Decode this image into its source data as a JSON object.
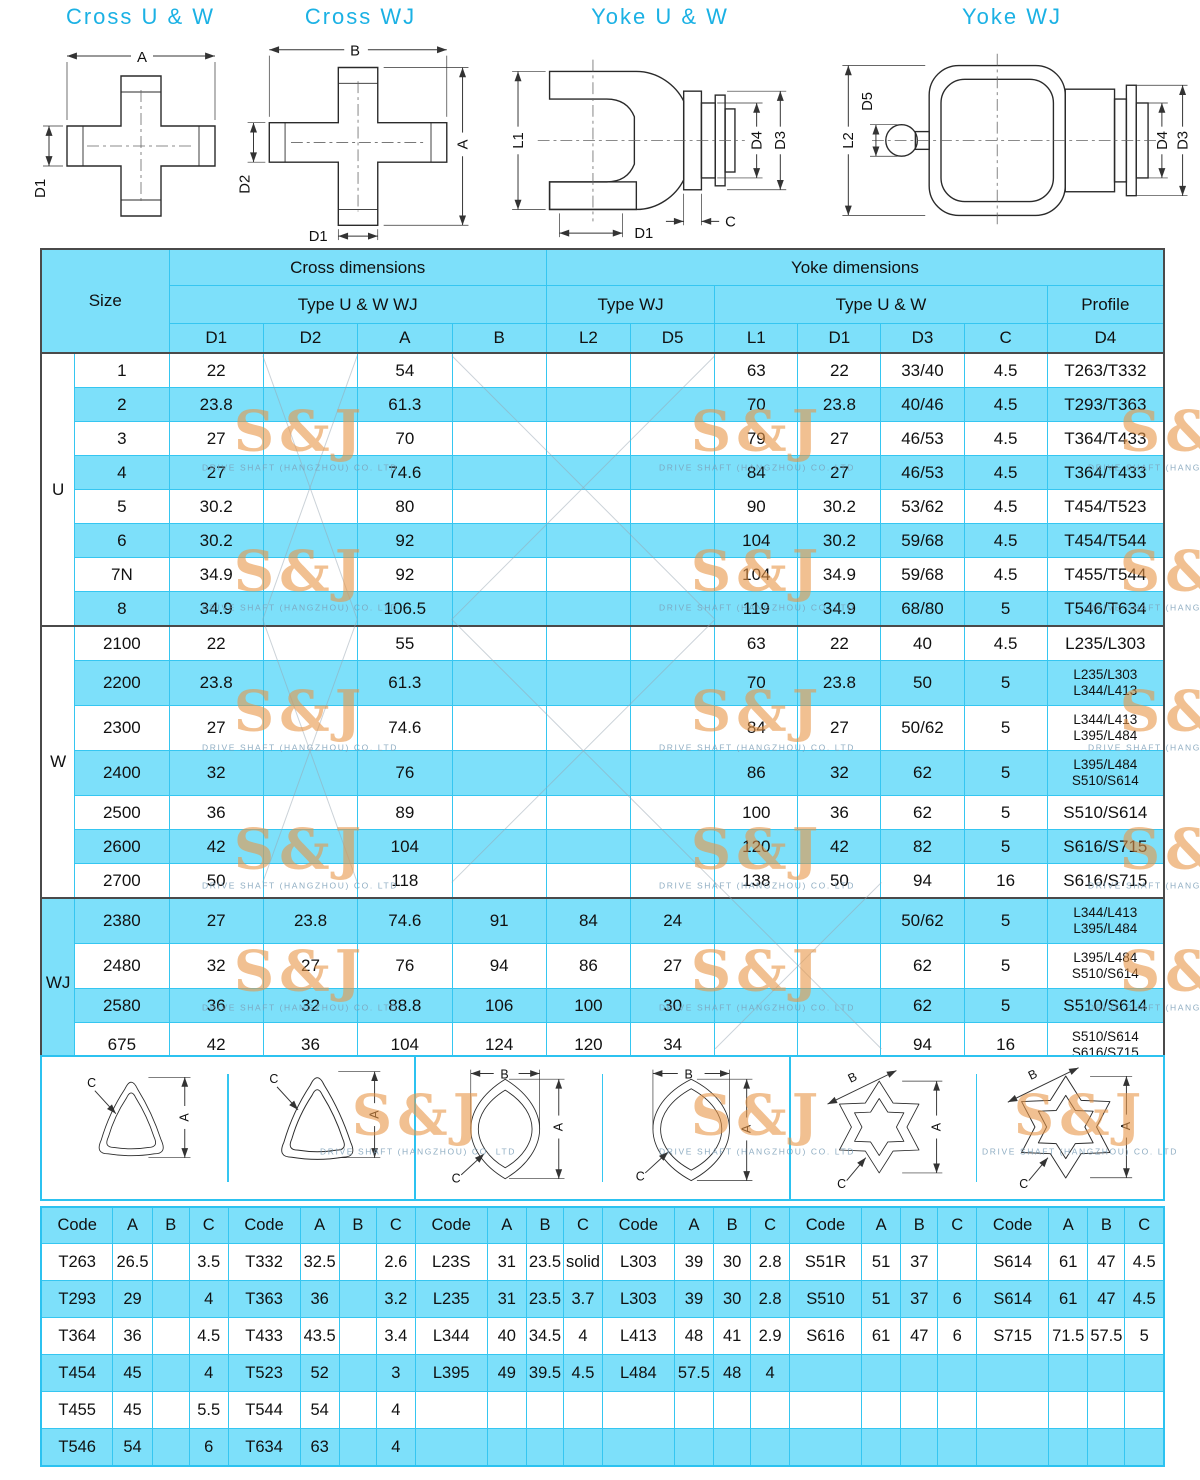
{
  "watermark": {
    "logo": "S&J",
    "company": "DRIVE SHAFT (HANGZHOU) CO. LTD"
  },
  "colors": {
    "title_cyan": "#1BB1E4",
    "border_cyan": "#35C6F1",
    "row_blue": "#7DE0FA",
    "section_line": "#4a4a4a",
    "watermark_orange": "#E89648"
  },
  "diagrams": {
    "titles": [
      "Cross  U & W",
      "Cross  WJ",
      "Yoke  U & W",
      "Yoke  WJ"
    ],
    "cross_uw_labels": [
      "A",
      "D1"
    ],
    "cross_wj_labels": [
      "B",
      "A",
      "D2",
      "D1"
    ],
    "yoke_uw_labels": [
      "L1",
      "D4",
      "D3",
      "C",
      "D1"
    ],
    "yoke_wj_labels": [
      "L2",
      "D5",
      "D4",
      "D3"
    ]
  },
  "main_table": {
    "header": {
      "size": "Size",
      "cross": "Cross dimensions",
      "yoke": "Yoke dimensions",
      "type_cross": "Type U & W  WJ",
      "type_wj": "Type WJ",
      "type_uw": "Type U & W",
      "profile": "Profile",
      "cols": [
        "D1",
        "D2",
        "A",
        "B",
        "L2",
        "D5",
        "L1",
        "D1",
        "D3",
        "C",
        "D4"
      ]
    },
    "sections": [
      {
        "group": "U",
        "rows": [
          [
            "1",
            "22",
            "",
            "54",
            "",
            "",
            "",
            "63",
            "22",
            "33/40",
            "4.5",
            "T263/T332"
          ],
          [
            "2",
            "23.8",
            "",
            "61.3",
            "",
            "",
            "",
            "70",
            "23.8",
            "40/46",
            "4.5",
            "T293/T363"
          ],
          [
            "3",
            "27",
            "",
            "70",
            "",
            "",
            "",
            "79",
            "27",
            "46/53",
            "4.5",
            "T364/T433"
          ],
          [
            "4",
            "27",
            "",
            "74.6",
            "",
            "",
            "",
            "84",
            "27",
            "46/53",
            "4.5",
            "T364/T433"
          ],
          [
            "5",
            "30.2",
            "",
            "80",
            "",
            "",
            "",
            "90",
            "30.2",
            "53/62",
            "4.5",
            "T454/T523"
          ],
          [
            "6",
            "30.2",
            "",
            "92",
            "",
            "",
            "",
            "104",
            "30.2",
            "59/68",
            "4.5",
            "T454/T544"
          ],
          [
            "7N",
            "34.9",
            "",
            "92",
            "",
            "",
            "",
            "104",
            "34.9",
            "59/68",
            "4.5",
            "T455/T544"
          ],
          [
            "8",
            "34.9",
            "",
            "106.5",
            "",
            "",
            "",
            "119",
            "34.9",
            "68/80",
            "5",
            "T546/T634"
          ]
        ]
      },
      {
        "group": "W",
        "rows": [
          [
            "2100",
            "22",
            "",
            "55",
            "",
            "",
            "",
            "63",
            "22",
            "40",
            "4.5",
            "L235/L303"
          ],
          [
            "2200",
            "23.8",
            "",
            "61.3",
            "",
            "",
            "",
            "70",
            "23.8",
            "50",
            "5",
            [
              "L235/L303",
              "L344/L413"
            ]
          ],
          [
            "2300",
            "27",
            "",
            "74.6",
            "",
            "",
            "",
            "84",
            "27",
            "50/62",
            "5",
            [
              "L344/L413",
              "L395/L484"
            ]
          ],
          [
            "2400",
            "32",
            "",
            "76",
            "",
            "",
            "",
            "86",
            "32",
            "62",
            "5",
            [
              "L395/L484",
              "S510/S614"
            ]
          ],
          [
            "2500",
            "36",
            "",
            "89",
            "",
            "",
            "",
            "100",
            "36",
            "62",
            "5",
            "S510/S614"
          ],
          [
            "2600",
            "42",
            "",
            "104",
            "",
            "",
            "",
            "120",
            "42",
            "82",
            "5",
            "S616/S715"
          ],
          [
            "2700",
            "50",
            "",
            "118",
            "",
            "",
            "",
            "138",
            "50",
            "94",
            "16",
            "S616/S715"
          ]
        ]
      },
      {
        "group": "WJ",
        "rows": [
          [
            "2380",
            "27",
            "23.8",
            "74.6",
            "91",
            "84",
            "24",
            "",
            "",
            "50/62",
            "5",
            [
              "L344/L413",
              "L395/L484"
            ]
          ],
          [
            "2480",
            "32",
            "27",
            "76",
            "94",
            "86",
            "27",
            "",
            "",
            "62",
            "5",
            [
              "L395/L484",
              "S510/S614"
            ]
          ],
          [
            "2580",
            "36",
            "32",
            "88.8",
            "106",
            "100",
            "30",
            "",
            "",
            "62",
            "5",
            "S510/S614"
          ],
          [
            "675",
            "42",
            "36",
            "104",
            "124",
            "120",
            "34",
            "",
            "",
            "94",
            "16",
            [
              "S510/S614",
              "S616/S715"
            ]
          ]
        ]
      }
    ]
  },
  "profiles": {
    "dim_labels": {
      "a": "A",
      "b": "B",
      "c": "C"
    }
  },
  "code_table": {
    "group_header": [
      "Code",
      "A",
      "B",
      "C"
    ],
    "rows": [
      [
        "T263",
        "26.5",
        "",
        "3.5",
        "T332",
        "32.5",
        "",
        "2.6",
        "L23S",
        "31",
        "23.5",
        "solid",
        "L303",
        "39",
        "30",
        "2.8",
        "S51R",
        "51",
        "37",
        "",
        "S614",
        "61",
        "47",
        "4.5"
      ],
      [
        "T293",
        "29",
        "",
        "4",
        "T363",
        "36",
        "",
        "3.2",
        "L235",
        "31",
        "23.5",
        "3.7",
        "L303",
        "39",
        "30",
        "2.8",
        "S510",
        "51",
        "37",
        "6",
        "S614",
        "61",
        "47",
        "4.5"
      ],
      [
        "T364",
        "36",
        "",
        "4.5",
        "T433",
        "43.5",
        "",
        "3.4",
        "L344",
        "40",
        "34.5",
        "4",
        "L413",
        "48",
        "41",
        "2.9",
        "S616",
        "61",
        "47",
        "6",
        "S715",
        "71.5",
        "57.5",
        "5"
      ],
      [
        "T454",
        "45",
        "",
        "4",
        "T523",
        "52",
        "",
        "3",
        "L395",
        "49",
        "39.5",
        "4.5",
        "L484",
        "57.5",
        "48",
        "4",
        "",
        "",
        "",
        "",
        "",
        "",
        "",
        ""
      ],
      [
        "T455",
        "45",
        "",
        "5.5",
        "T544",
        "54",
        "",
        "4",
        "",
        "",
        "",
        "",
        "",
        "",
        "",
        "",
        "",
        "",
        "",
        "",
        "",
        "",
        "",
        ""
      ],
      [
        "T546",
        "54",
        "",
        "6",
        "T634",
        "63",
        "",
        "4",
        "",
        "",
        "",
        "",
        "",
        "",
        "",
        "",
        "",
        "",
        "",
        "",
        "",
        "",
        "",
        ""
      ]
    ]
  }
}
